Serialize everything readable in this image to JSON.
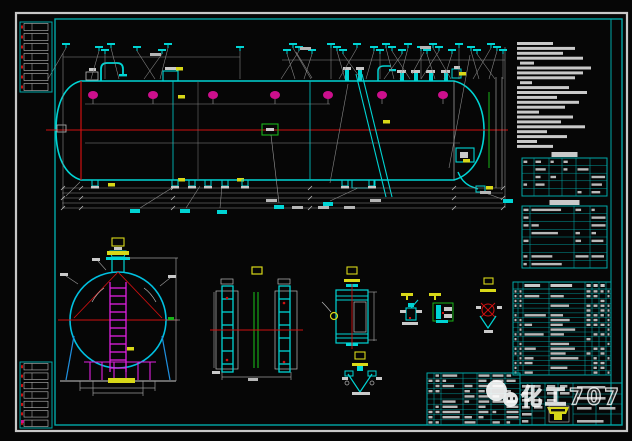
{
  "app": {
    "type": "cad-drawing-viewport"
  },
  "watermark": {
    "text": "化工707"
  },
  "palette": {
    "frame_white": "#c8c8c8",
    "frame_cyan": "#00a8a8",
    "line_cyan": "#00d4d4",
    "line_red": "#cf1010",
    "flange_magenta": "#cc0f8c",
    "ladder_magenta": "#e020e0",
    "line_green": "#18b418",
    "line_yellow": "#d8d818",
    "line_gray": "#8a8a8a",
    "blur_text": "#c9c9c9",
    "saddle_blue": "#2090e0"
  },
  "notes": {
    "x": 517,
    "y": 42,
    "line_height": 4.9,
    "bar_height": 3,
    "widths": [
      36,
      58,
      46,
      66,
      14,
      74,
      66,
      58,
      12,
      52,
      70,
      40,
      62,
      48,
      22,
      56,
      44,
      68,
      30,
      50,
      20,
      36
    ]
  },
  "main_view": {
    "flange_y": 95,
    "flange_xs": [
      93,
      153,
      213,
      275,
      328,
      382,
      443
    ],
    "flag_xs": [
      66,
      99,
      105,
      111,
      137,
      162,
      168,
      240,
      287,
      293,
      299,
      312,
      331,
      337,
      343,
      357,
      374,
      380,
      386,
      392,
      402,
      408,
      421,
      427,
      433,
      439,
      452,
      459,
      471,
      477,
      491,
      497,
      503
    ],
    "bottom_fitting_xs": [
      95,
      175,
      192,
      208,
      225,
      245,
      345,
      372
    ],
    "dim_line_ys": [
      188,
      193,
      198,
      203,
      208
    ],
    "tick_xs": [
      63,
      81,
      173,
      310,
      454,
      503
    ],
    "cyan_labels": [
      [
        130,
        209
      ],
      [
        180,
        209
      ],
      [
        217,
        210
      ],
      [
        323,
        202
      ],
      [
        274,
        205
      ],
      [
        503,
        199
      ]
    ],
    "gray_labels": [
      [
        266,
        199
      ],
      [
        292,
        206
      ],
      [
        318,
        206
      ],
      [
        344,
        206
      ],
      [
        370,
        199
      ],
      [
        480,
        191
      ],
      [
        150,
        53
      ],
      [
        300,
        47
      ],
      [
        420,
        46
      ]
    ],
    "yellow_marks": [
      [
        176,
        67
      ],
      [
        178,
        95
      ],
      [
        383,
        120
      ],
      [
        108,
        183
      ],
      [
        178,
        178
      ],
      [
        237,
        178
      ],
      [
        463,
        159
      ],
      [
        486,
        186
      ],
      [
        459,
        72
      ],
      [
        127,
        347
      ]
    ]
  },
  "tables": {
    "notes_small": {
      "x": 522,
      "y": 158,
      "w": 85,
      "h": 38,
      "rows": 5,
      "col_xs": [
        12,
        27,
        40,
        54,
        68
      ],
      "tab": 26
    },
    "spec_small": {
      "x": 522,
      "y": 206,
      "w": 85,
      "h": 62,
      "rows": 8,
      "col_xs": [
        8,
        52,
        68
      ],
      "tab": 30
    },
    "bom": {
      "x": 513,
      "y": 282,
      "w": 98,
      "h": 93,
      "rows": 18,
      "col_xs": [
        5,
        10,
        36,
        72,
        79,
        86,
        93
      ],
      "header_h": 7
    },
    "sign_block": {
      "x": 427,
      "y": 373,
      "w": 93,
      "h": 52,
      "rows": 10,
      "col_xs": [
        7,
        14,
        36,
        50,
        64,
        78
      ]
    }
  },
  "strips": {
    "top": {
      "x": 20,
      "y": 22,
      "w": 32,
      "h": 70,
      "rows": 7
    },
    "bottom": {
      "x": 20,
      "y": 362,
      "w": 32,
      "h": 66,
      "rows": 7
    }
  }
}
